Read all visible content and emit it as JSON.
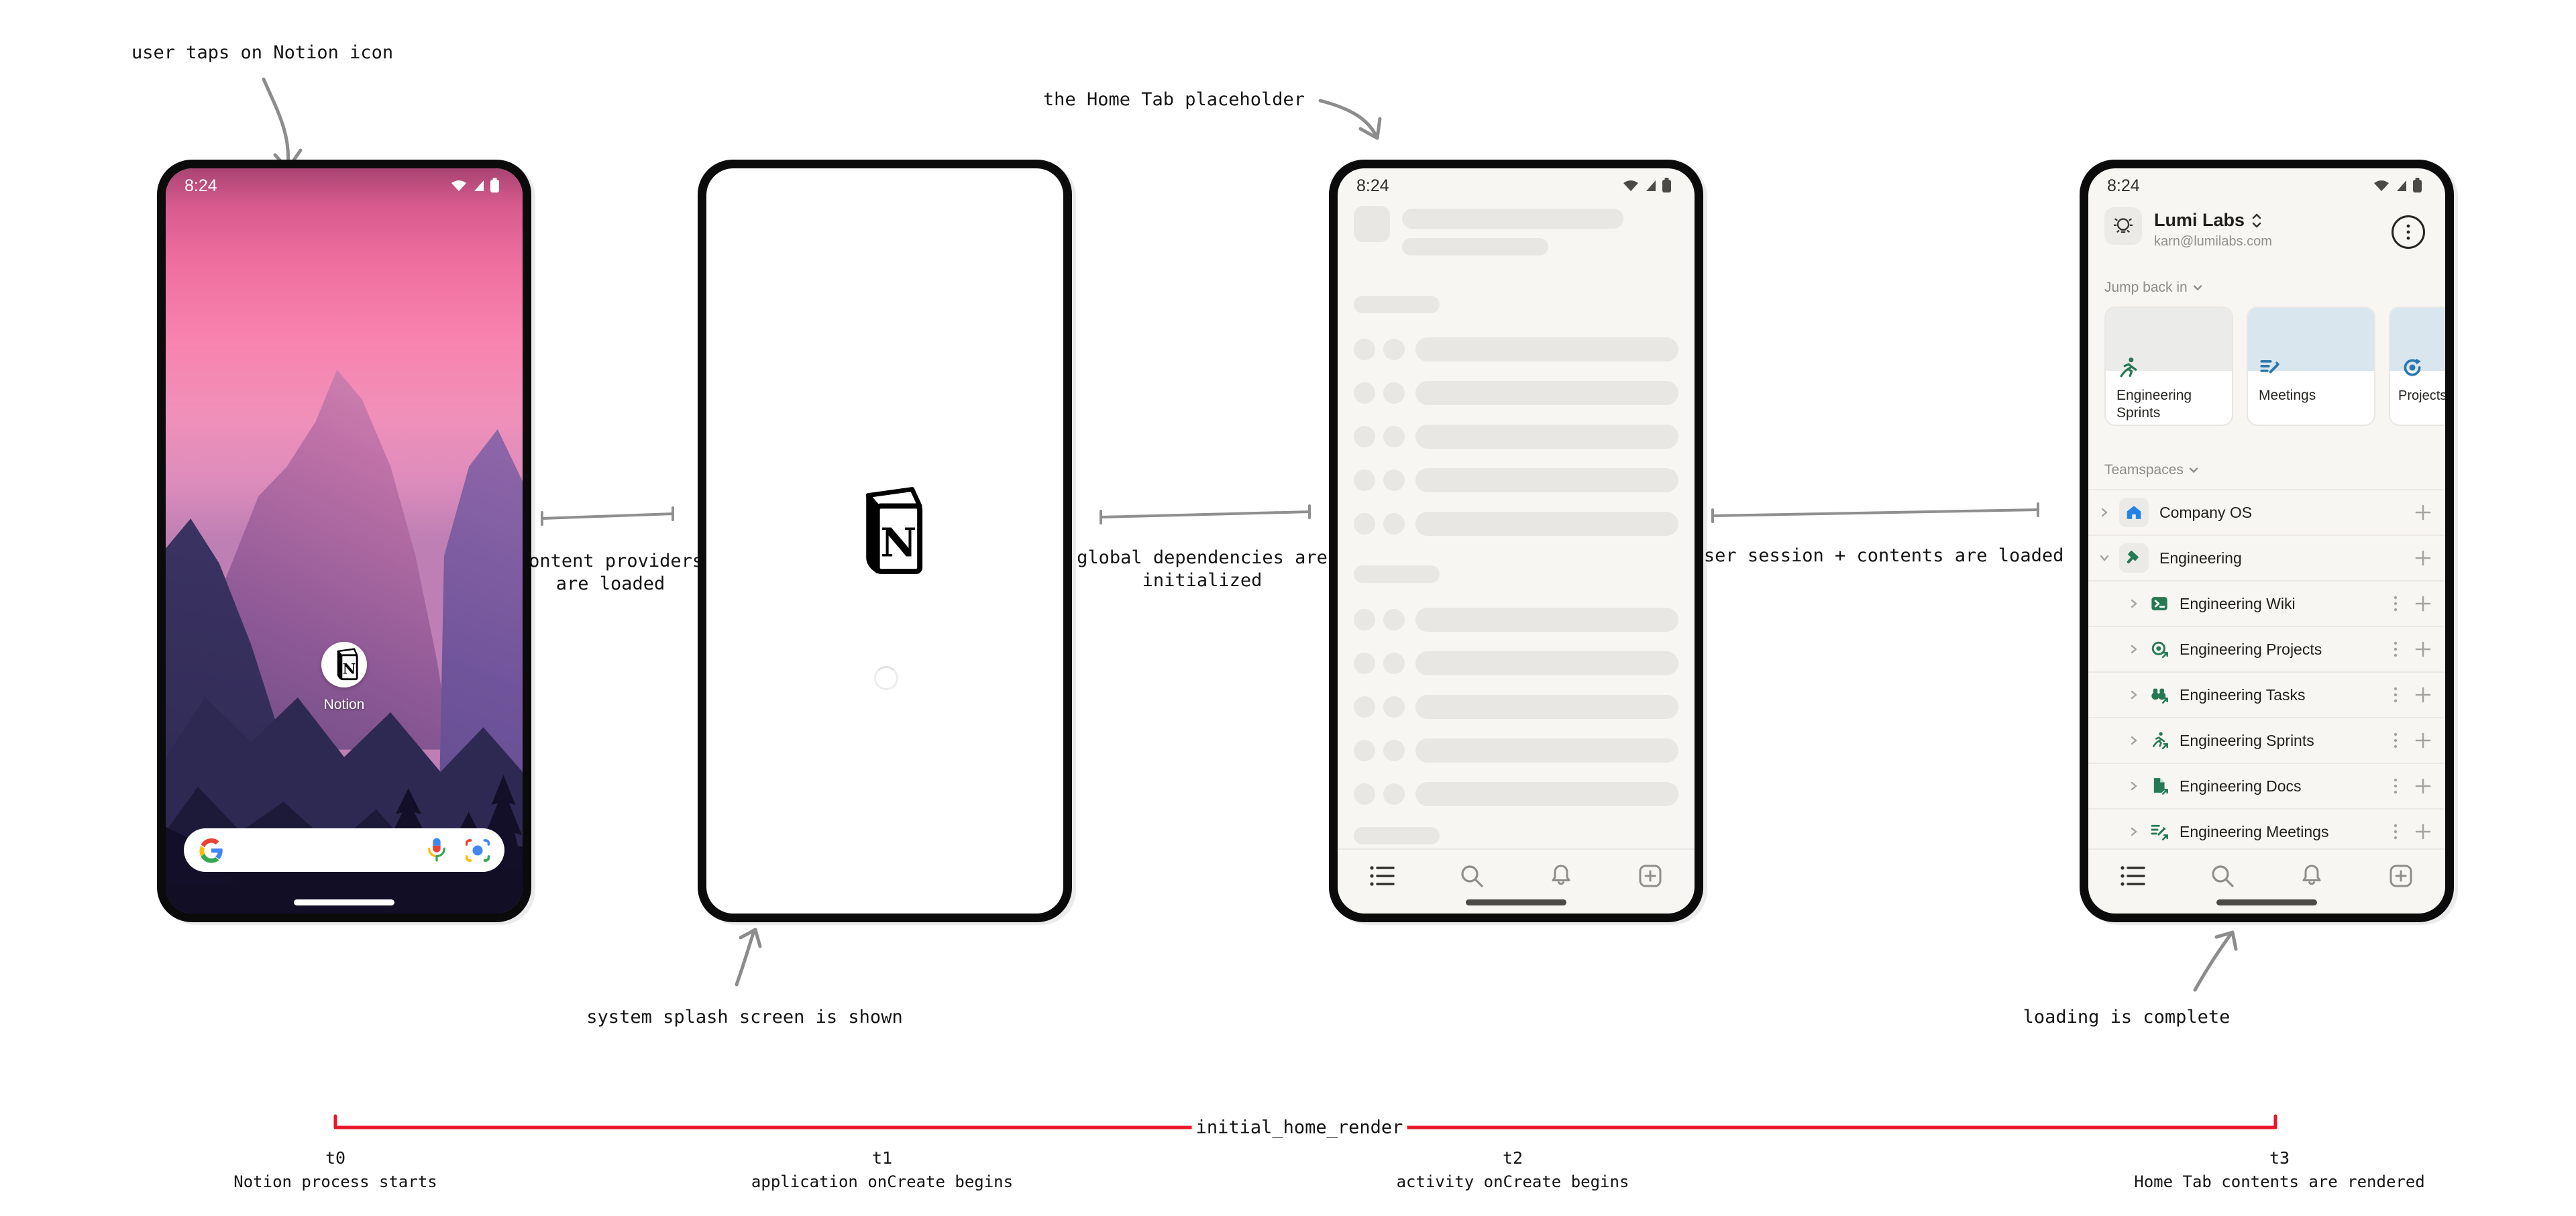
{
  "annotations": {
    "tap": "user taps on Notion icon",
    "content_providers": "content providers are loaded",
    "splash_shown": "system splash screen is shown",
    "home_tab_placeholder": "the Home Tab placeholder",
    "global_deps": "global dependencies are initialized",
    "user_session": "user session + contents are loaded",
    "loading_complete": "loading is complete"
  },
  "timeline": {
    "label": "initial_home_render",
    "color": "#e8182c",
    "points": [
      {
        "t": "t0",
        "desc": "Notion process starts"
      },
      {
        "t": "t1",
        "desc": "application onCreate begins"
      },
      {
        "t": "t2",
        "desc": "activity onCreate begins"
      },
      {
        "t": "t3",
        "desc": "Home Tab contents are rendered"
      }
    ]
  },
  "logo_letter": "N",
  "phones": {
    "home": {
      "time": "8:24",
      "app_label": "Notion"
    },
    "placeholder": {
      "time": "8:24"
    },
    "loaded": {
      "time": "8:24",
      "workspace_name": "Lumi Labs",
      "workspace_email": "karn@lumilabs.com",
      "jump_back_in": "Jump back in",
      "teamspaces_label": "Teamspaces",
      "cards": [
        {
          "label": "Engineering Sprints",
          "icon": "runner-icon",
          "cap_color": "#ebebe9"
        },
        {
          "label": "Meetings",
          "icon": "doc-pencil-icon",
          "cap_color": "#dae6ee"
        },
        {
          "label": "Projects",
          "icon": "sync-icon",
          "cap_color": "#dae6ee"
        }
      ],
      "teamspaces": [
        {
          "label": "Company OS",
          "icon": "house-icon"
        },
        {
          "label": "Engineering",
          "icon": "hammer-icon"
        }
      ],
      "pages": [
        {
          "label": "Engineering Wiki",
          "icon": "terminal-icon"
        },
        {
          "label": "Engineering Projects",
          "icon": "target-icon"
        },
        {
          "label": "Engineering Tasks",
          "icon": "binoculars-icon"
        },
        {
          "label": "Engineering Sprints",
          "icon": "runner-icon"
        },
        {
          "label": "Engineering Docs",
          "icon": "doc-icon"
        },
        {
          "label": "Engineering Meetings",
          "icon": "meeting-icon"
        }
      ]
    }
  },
  "colors": {
    "green": "#267a53",
    "blue": "#2383e2",
    "card_blue": "#2b77ae",
    "skeleton": "#e8e7e3",
    "screen_bg": "#f7f6f3",
    "timeline_red": "#e8182c",
    "annotation_gray": "#8c8c8c"
  }
}
